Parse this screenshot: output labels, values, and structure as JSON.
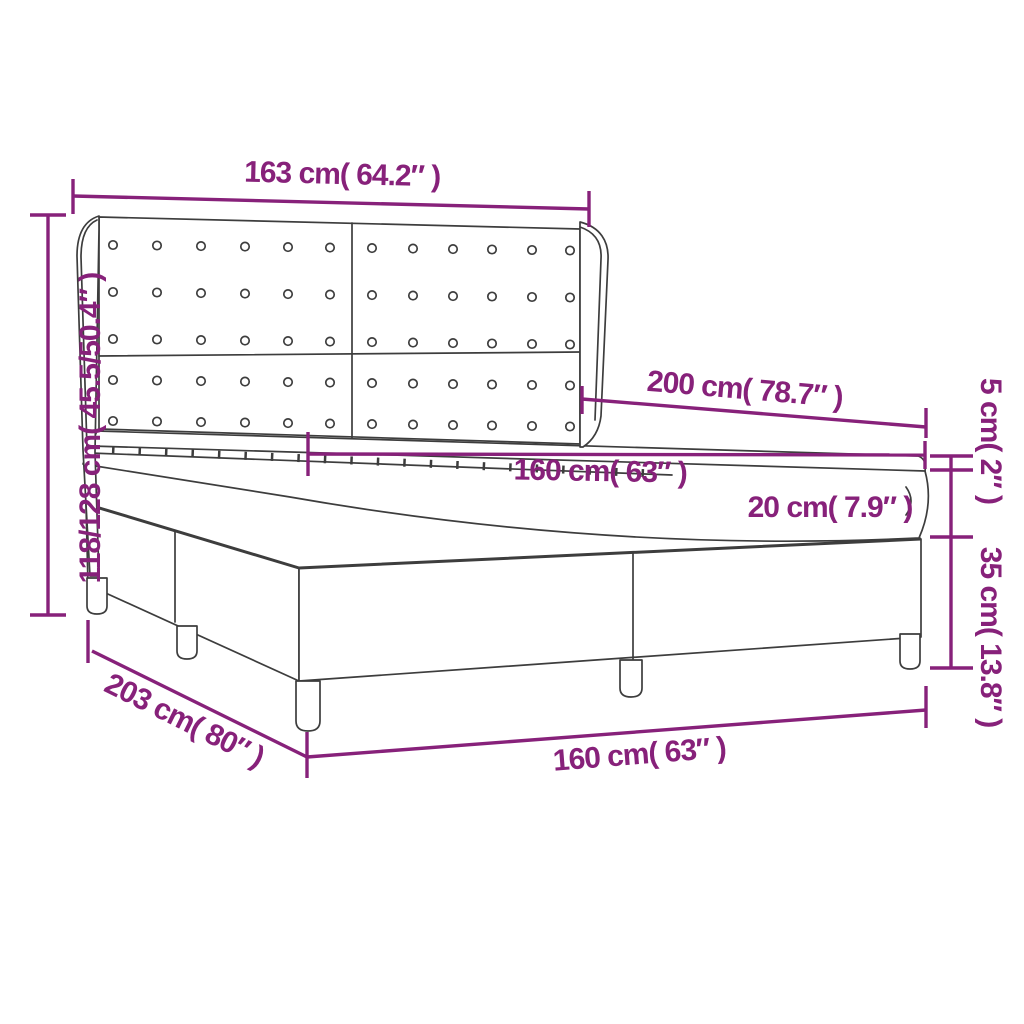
{
  "figure": {
    "type": "product-dimension-diagram",
    "subject": "box spring bed with winged tufted headboard",
    "colors": {
      "dimension_accent": "#87217A",
      "drawing_outline": "#3D3D3D",
      "background": "#FFFFFF"
    },
    "labels": {
      "headboard_width": "163 cm( 64.2″ )",
      "headboard_height": "118/128 cm( 45.5/50.4″ )",
      "mattress_length": "200 cm( 78.7″ )",
      "mattress_width_top": "160 cm( 63″ )",
      "mattress_thickness": "20 cm( 7.9″ )",
      "topper_thickness": "5 cm( 2″ )",
      "base_height": "35 cm( 13.8″ )",
      "bed_length": "203 cm( 80″ )",
      "bed_width_bottom": "160 cm( 63″ )"
    }
  }
}
